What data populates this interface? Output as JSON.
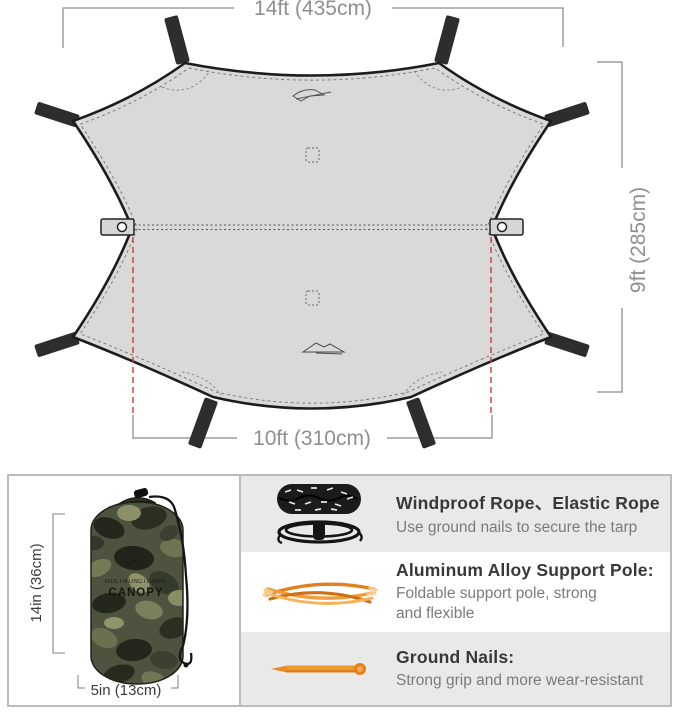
{
  "diagram": {
    "top_width": "14ft (435cm)",
    "side_height": "9ft (285cm)",
    "bottom_width": "10ft (310cm)"
  },
  "package_bag": {
    "height": "14in (36cm)",
    "width": "5in (13cm)",
    "print_line1": "MULTIFUNCTIONAL",
    "print_line2": "CANOPY"
  },
  "accessories": [
    {
      "icon": "rope-icon",
      "title": "Windproof Rope、Elastic Rope",
      "desc": "Use ground nails to secure the tarp"
    },
    {
      "icon": "pole-icon",
      "title": "Aluminum Alloy Support Pole:",
      "desc": "Foldable support pole, strong\nand flexible"
    },
    {
      "icon": "nail-icon",
      "title": "Ground Nails:",
      "desc": "Strong grip and more wear-resistant"
    }
  ],
  "colors": {
    "tarp_fill": "#D9D9D9",
    "outline": "#1C1C1C",
    "dimension_gray": "#9B9B9B",
    "guide_red": "#CC3B35",
    "row_bg": "#E9E9E9",
    "accent_orange": "#E8872B"
  }
}
